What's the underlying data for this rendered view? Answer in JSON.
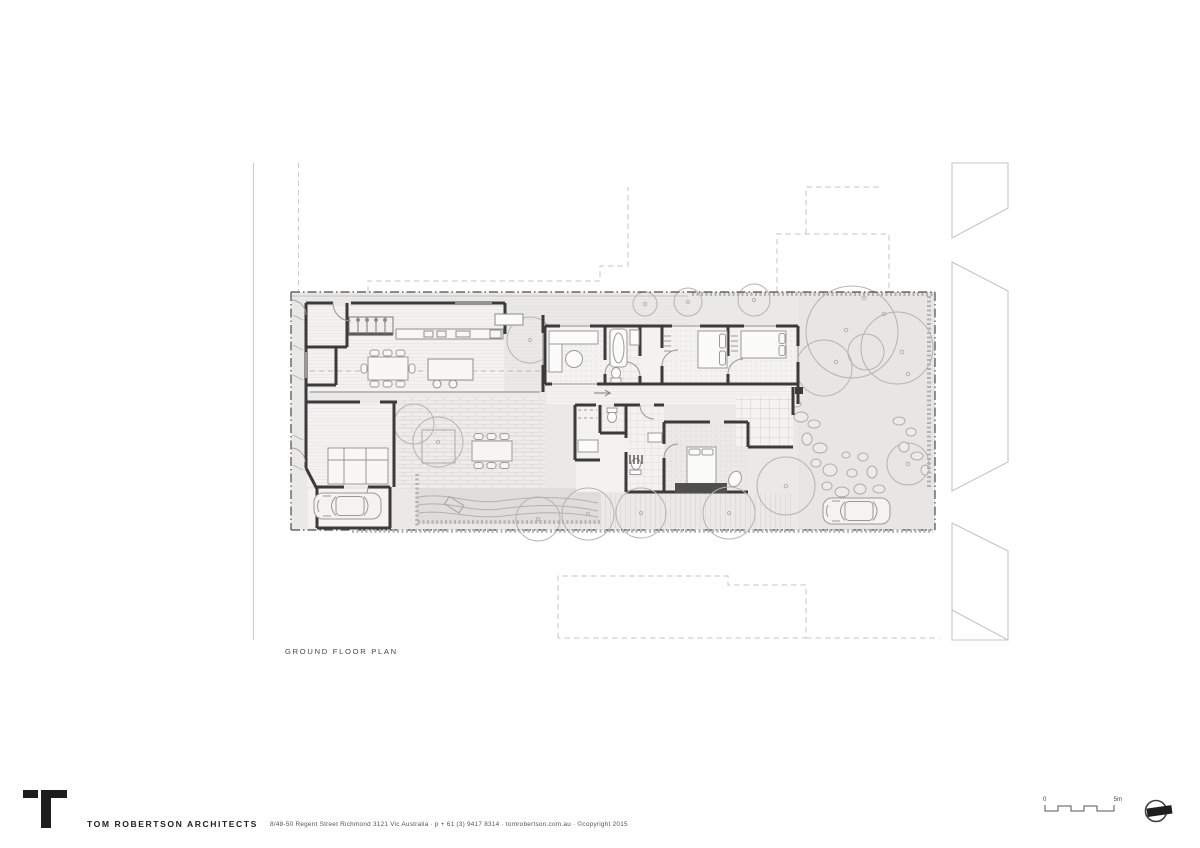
{
  "sheet": {
    "title": "GROUND FLOOR PLAN",
    "firm": "TOM ROBERTSON ARCHITECTS",
    "contact": "8/48-50 Regent Street Richmond 3121 Vic Australia · p + 61 (3) 9417 8314 · tomrobertson.com.au · ©copyright 2015",
    "scale": {
      "start": "0",
      "end": "5m"
    },
    "icons": {
      "logo": "tra-t-logo-icon",
      "north": "north-arrow-icon"
    },
    "colors": {
      "wall": "#3b3b3b",
      "site_fill": "#eae9e8",
      "garden_fill": "#e7e6e5",
      "landscape_line": "#b4b3b1",
      "boundary_line": "#4b4b4a",
      "context_line": "#c7c6c5",
      "text": "#454545",
      "logo_black": "#1d1d1c"
    }
  }
}
